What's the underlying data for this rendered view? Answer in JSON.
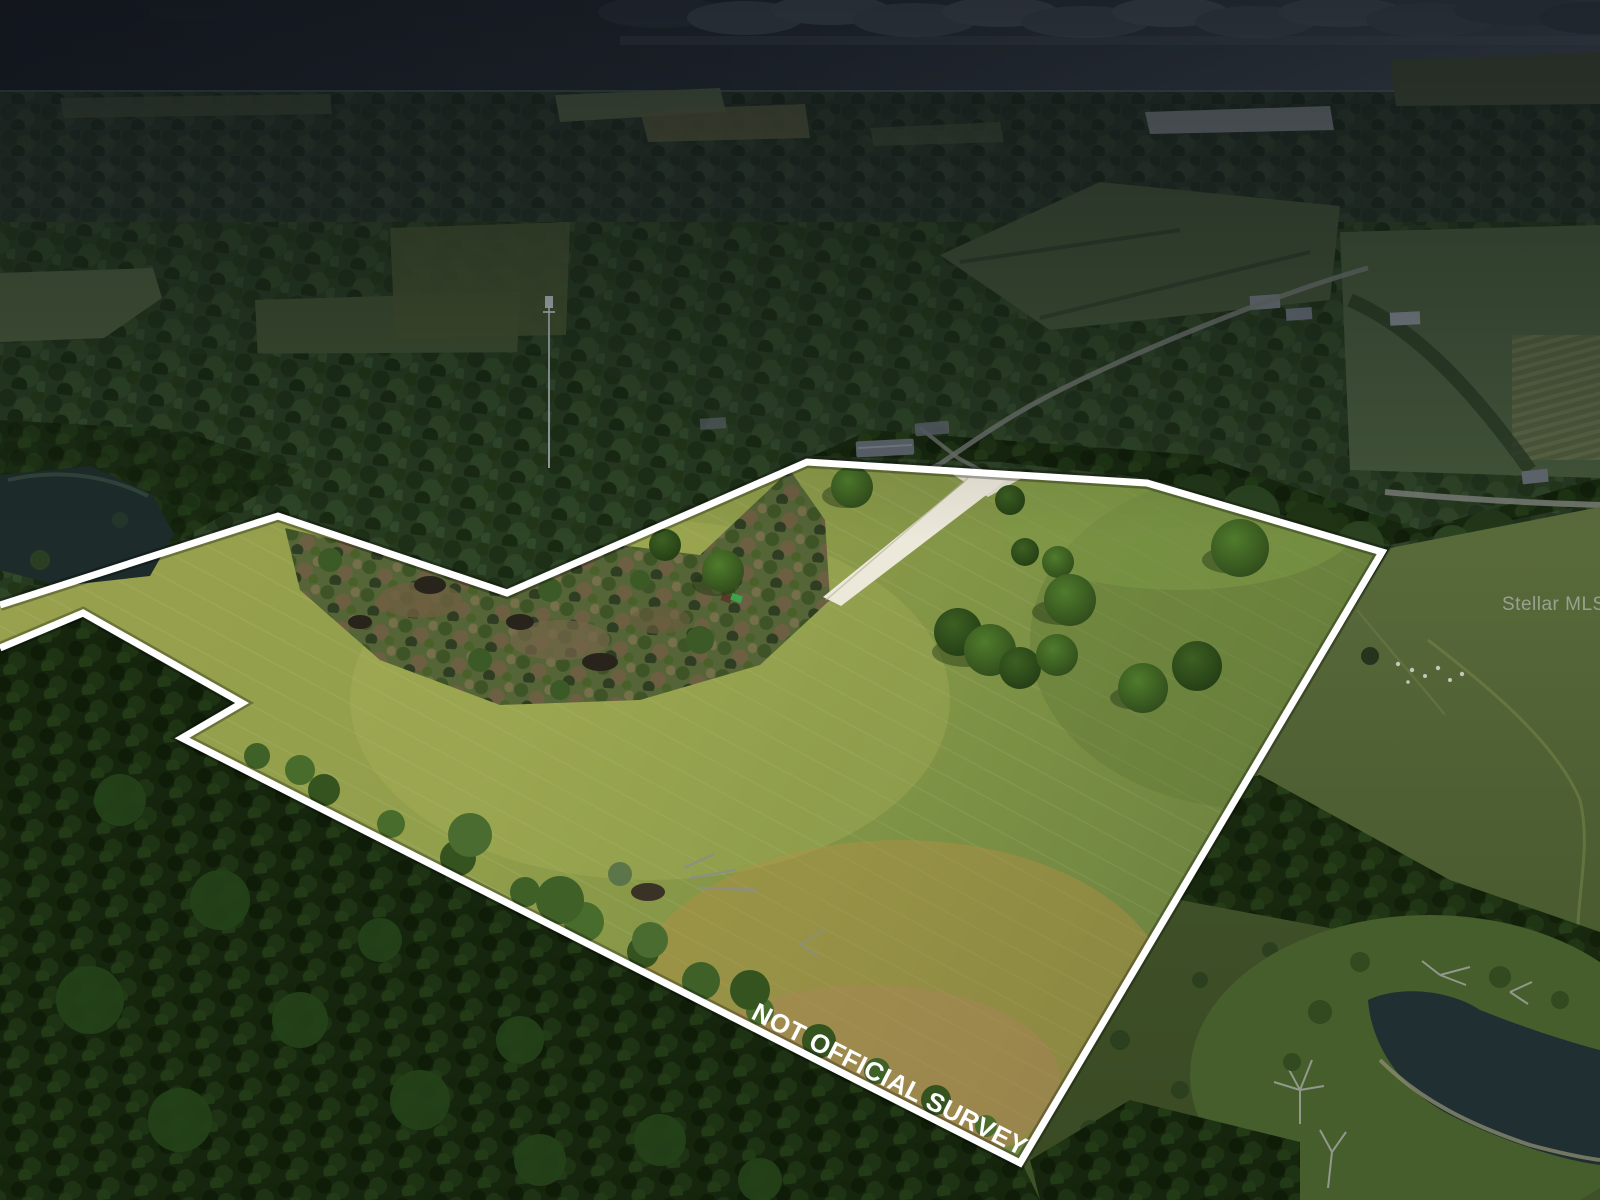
{
  "image": {
    "kind": "aerial-drone-real-estate-photo",
    "scene": "Large mowed pasture parcel outlined in white, surrounded by pine forest, rural roads, farm houses, two ponds and distant fields under a dark overcast horizon",
    "disclaimer_text": "NOT OFFICIAL SURVEY",
    "watermark_text": "Stellar MLS",
    "parcel_outline_color": "#ffffff"
  },
  "colors": {
    "sky_dark": "#1e232a",
    "cloud_band": "#4c545e",
    "forest_dark": "#18280f",
    "forest_mid": "#263a20",
    "pasture_bright": "#99a14e",
    "pasture_olive": "#6d8340",
    "pasture_tan": "#b08a4a",
    "east_pasture": "#4d5f31",
    "pond_water": "#1d2c2b",
    "driveway": "#ece8da",
    "road": "#6b716b",
    "tractor_green": "#3aa34b"
  }
}
